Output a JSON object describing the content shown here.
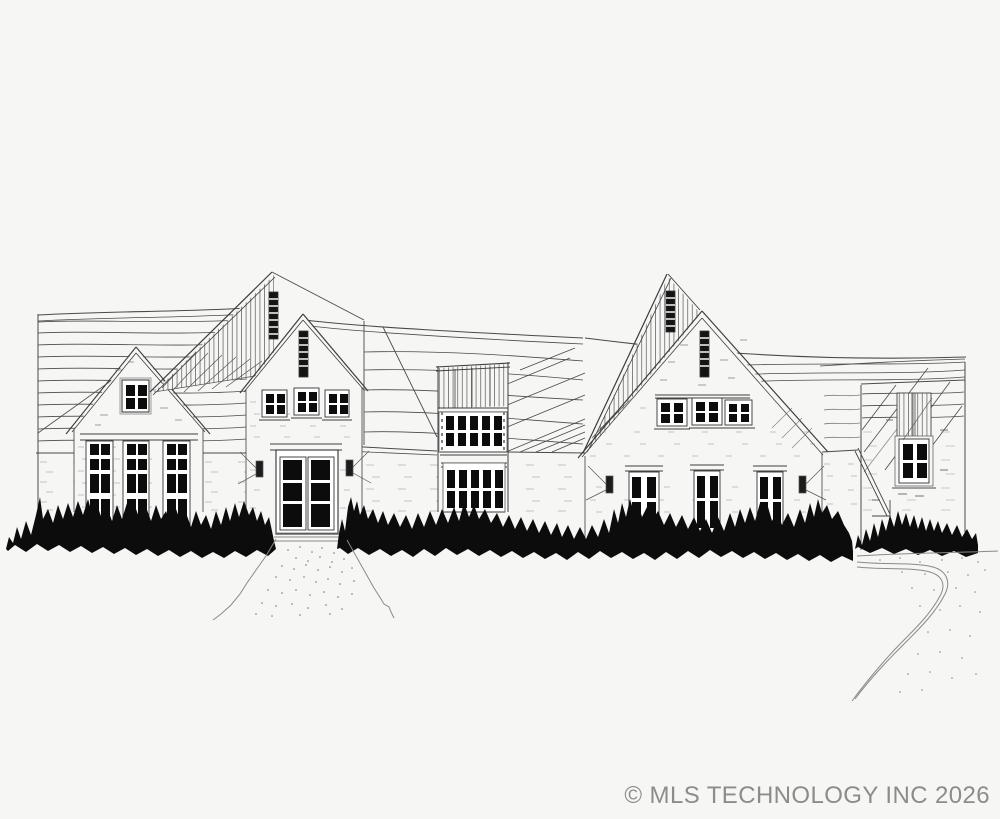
{
  "scene": {
    "type": "hand-drawn architectural front elevation sketch of a house",
    "elements": [
      "long hatched roof plane on the left",
      "left gabled wing with attic window and three tall mullioned windows",
      "steep striped entry gable with slit vents",
      "double front door with six dark panels and sconces",
      "central bay with striped parapet and two grids of small dark panes",
      "large right gable with striped roof slope, three paired windows and three tall windows",
      "detached right structure with striped dormer bay and four-pane window",
      "solid black shrub hedge along the foundation",
      "stippled front walkway",
      "curved driveway at lower right"
    ]
  },
  "palette": {
    "paper": "#f6f6f5",
    "ink": "#3d3d3d",
    "faint_ink": "#7d7d7d",
    "solid_black": "#0c0c0c",
    "watermark_gray": "#8e8c89"
  },
  "watermark": {
    "text": "© MLS TECHNOLOGY INC 2026"
  }
}
